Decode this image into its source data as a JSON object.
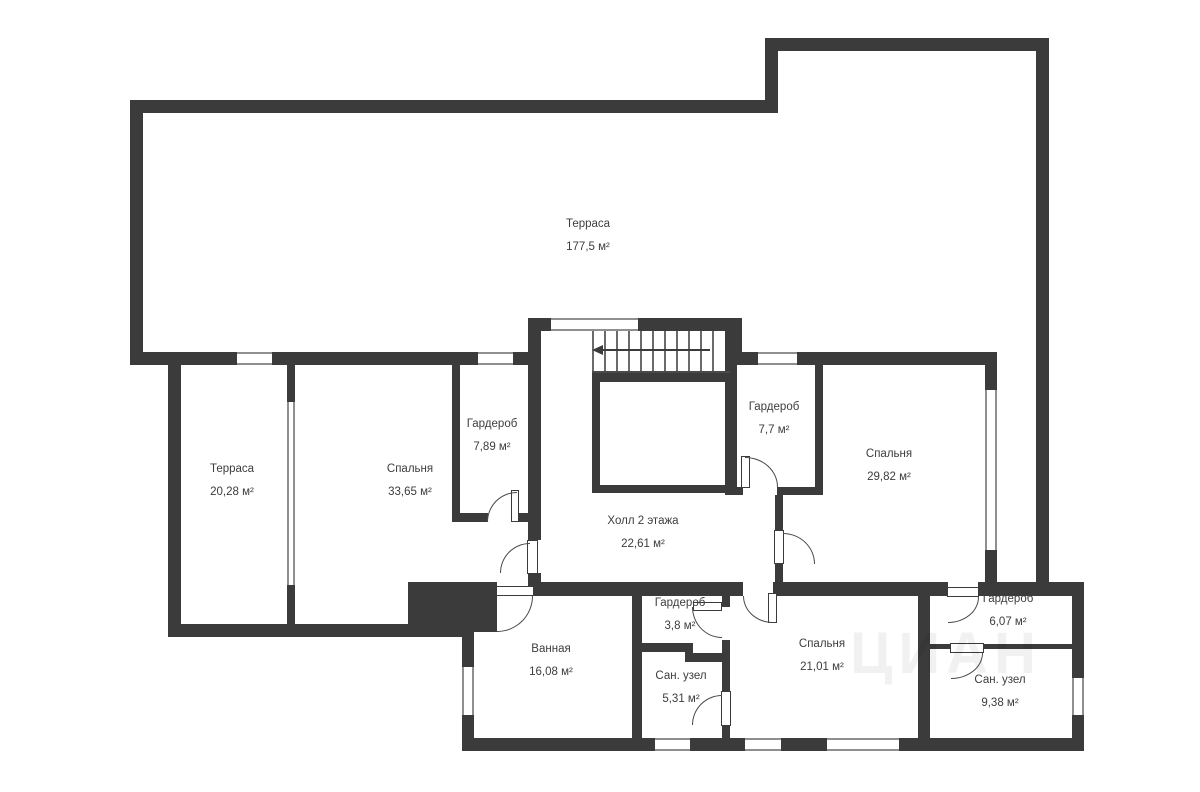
{
  "rooms": [
    {
      "name": "Терраса",
      "area": "177,5 м²"
    },
    {
      "name": "Терраса",
      "area": "20,28 м²"
    },
    {
      "name": "Спальня",
      "area": "33,65 м²"
    },
    {
      "name": "Гардероб",
      "area": "7,89 м²"
    },
    {
      "name": "Холл 2 этажа",
      "area": "22,61 м²"
    },
    {
      "name": "Гардероб",
      "area": "7,7 м²"
    },
    {
      "name": "Спальня",
      "area": "29,82 м²"
    },
    {
      "name": "Ванная",
      "area": "16,08 м²"
    },
    {
      "name": "Гардероб",
      "area": "3,8 м²"
    },
    {
      "name": "Сан. узел",
      "area": "5,31 м²"
    },
    {
      "name": "Спальня",
      "area": "21,01 м²"
    },
    {
      "name": "Гардероб",
      "area": "6,07 м²"
    },
    {
      "name": "Сан. узел",
      "area": "9,38 м²"
    }
  ],
  "colors": {
    "wall": "#3b3b3b",
    "background": "#ffffff",
    "label_text": "#3d3d3d"
  },
  "watermark": "ЦИАН"
}
